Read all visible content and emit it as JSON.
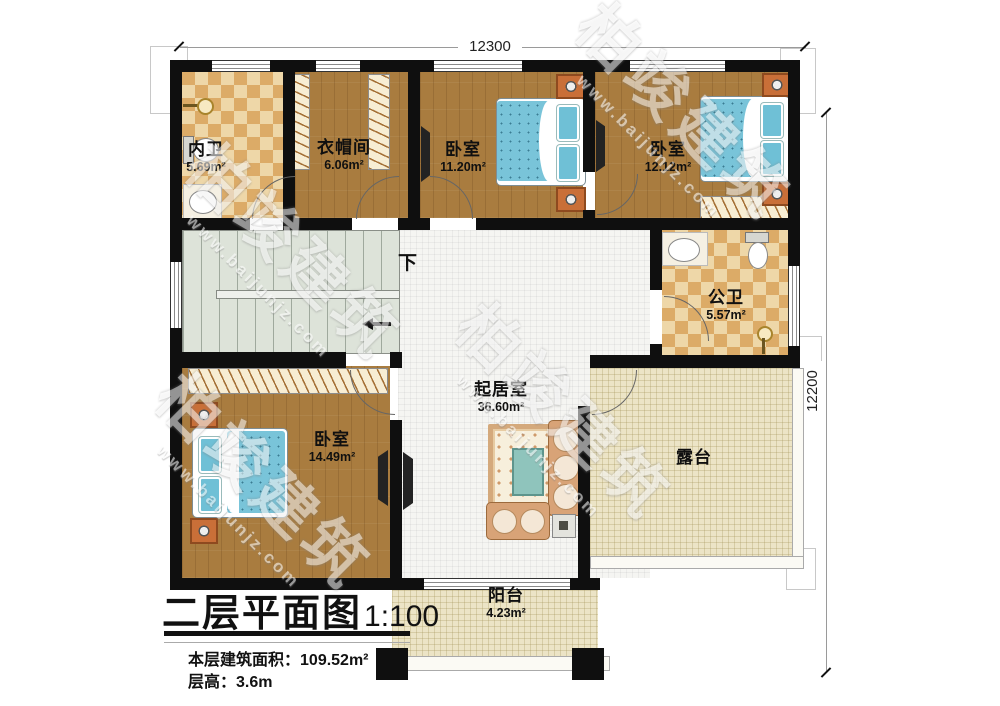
{
  "title": {
    "text": "二层平面图",
    "scale": "1:100",
    "stats": [
      {
        "label": "本层建筑面积：",
        "value": "109.52m²"
      },
      {
        "label": "层高：",
        "value": "3.6m"
      }
    ]
  },
  "dimensions": {
    "top": "12300",
    "right": "12200"
  },
  "stairs": {
    "direction_label": "下"
  },
  "rooms": {
    "inner_bath": {
      "name": "内卫",
      "area": "5.69m²"
    },
    "cloakroom": {
      "name": "衣帽间",
      "area": "6.06m²"
    },
    "bedroom_top_mid": {
      "name": "卧室",
      "area": "11.20m²"
    },
    "bedroom_top_right": {
      "name": "卧室",
      "area": "12.12m²"
    },
    "public_bath": {
      "name": "公卫",
      "area": "5.57m²"
    },
    "bedroom_bottom_left": {
      "name": "卧室",
      "area": "14.49m²"
    },
    "living_room": {
      "name": "起居室",
      "area": "36.60m²"
    },
    "terrace": {
      "name": "露台"
    },
    "balcony": {
      "name": "阳台",
      "area": "4.23m²"
    }
  },
  "watermark": {
    "brand": "柏竣建筑",
    "url": "www.baijunjz.com"
  },
  "colors": {
    "wall": "#0f0f0f",
    "wood_floor": "#a97c3f",
    "tile_light": "#eed7a8",
    "tile_dark": "#dcab67",
    "stair": "#dde3d9",
    "living_floor": "#f5f5f2",
    "terrace_floor": "#ece4c6",
    "bed_blue": "#79c4d9",
    "nightstand": "#c96f38"
  }
}
